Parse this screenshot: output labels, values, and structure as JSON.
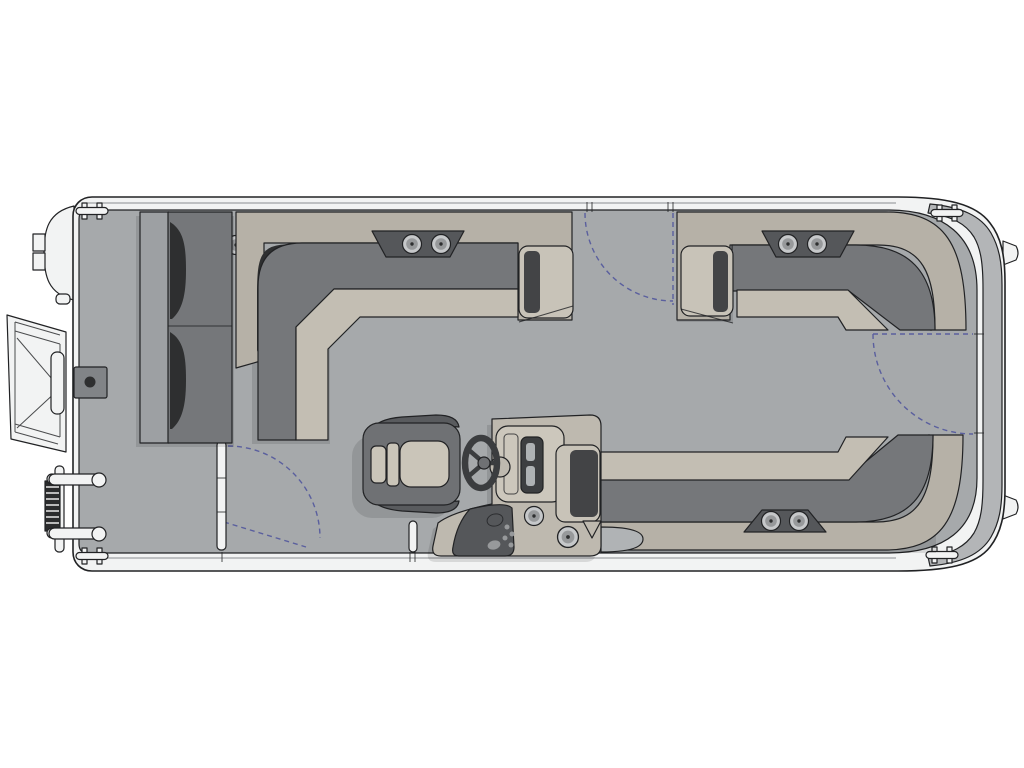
{
  "meta": {
    "title": "Pontoon boat deck floor plan — overhead view",
    "diagram_type": "boat layout line drawing",
    "canvas": {
      "width": 1024,
      "height": 768
    }
  },
  "palette": {
    "page_bg": "#ffffff",
    "hull": "#f2f3f3",
    "outline": "#212224",
    "soft_line": "#8b8d90",
    "floor": "#a6a9ab",
    "platform": "#b3b5b7",
    "panel": "#b6b1a7",
    "seat": "#c3beb3",
    "armrest": "#c8c3b8",
    "back": "#75777a",
    "back_deep": "#595b5e",
    "accent": "#2e2f30",
    "inset_dark": "#434446",
    "bow_seat": "#9da0a3",
    "console": "#beb9af",
    "bezel": "#ccc7bc",
    "vent": "#a9a59b",
    "console_panel": "#55575a",
    "screen": "#3d3f41",
    "slot": "#aeb2b4",
    "chair": "#6f7174",
    "chair_seat": "#cac5b9",
    "metal": "#c6c8ca",
    "metal_mid": "#97999b",
    "coil": "#2b2c2d",
    "tow_pad": "#818487",
    "d_pad": "#b0b3b5",
    "swing": "#5a5f9e",
    "shadow": "rgba(0,0,0,0.11)"
  },
  "parts": {
    "boat": "Pontoon boat deck plan, top view",
    "hull": "Pontoon hull and rail fence",
    "platform": "Stern platform",
    "nose_cone": "Port pontoon bow nose",
    "bow_gate": "Bow boarding gate, open",
    "bow_ladder": "Folding boarding ladder",
    "ski_tow": "Bow pedestal base",
    "bow_lounge": "Forward port lounge seat",
    "port_lounge": "Port L-shaped lounge",
    "starboard_lounge": "Starboard L-shaped lounge",
    "stern_lounge": "Aft L-shaped lounge",
    "captain_chair": "Captain's chair",
    "helm_console": "Helm console",
    "steering_wheel": "Steering wheel",
    "instrument_cluster": "Instrument cluster",
    "throttle_panel": "Switch and throttle panel",
    "speakers": "Speakers",
    "cup_holders": "Cup holders",
    "cleats": "Mooring cleats",
    "side_gate": "Port side gate, open",
    "gate_post": "Gate post",
    "side_gate_swing": "Side gate swing path",
    "bow_gate_swing": "Forward gate swing path",
    "stern_gate_swing": "Stern gate swing path"
  }
}
